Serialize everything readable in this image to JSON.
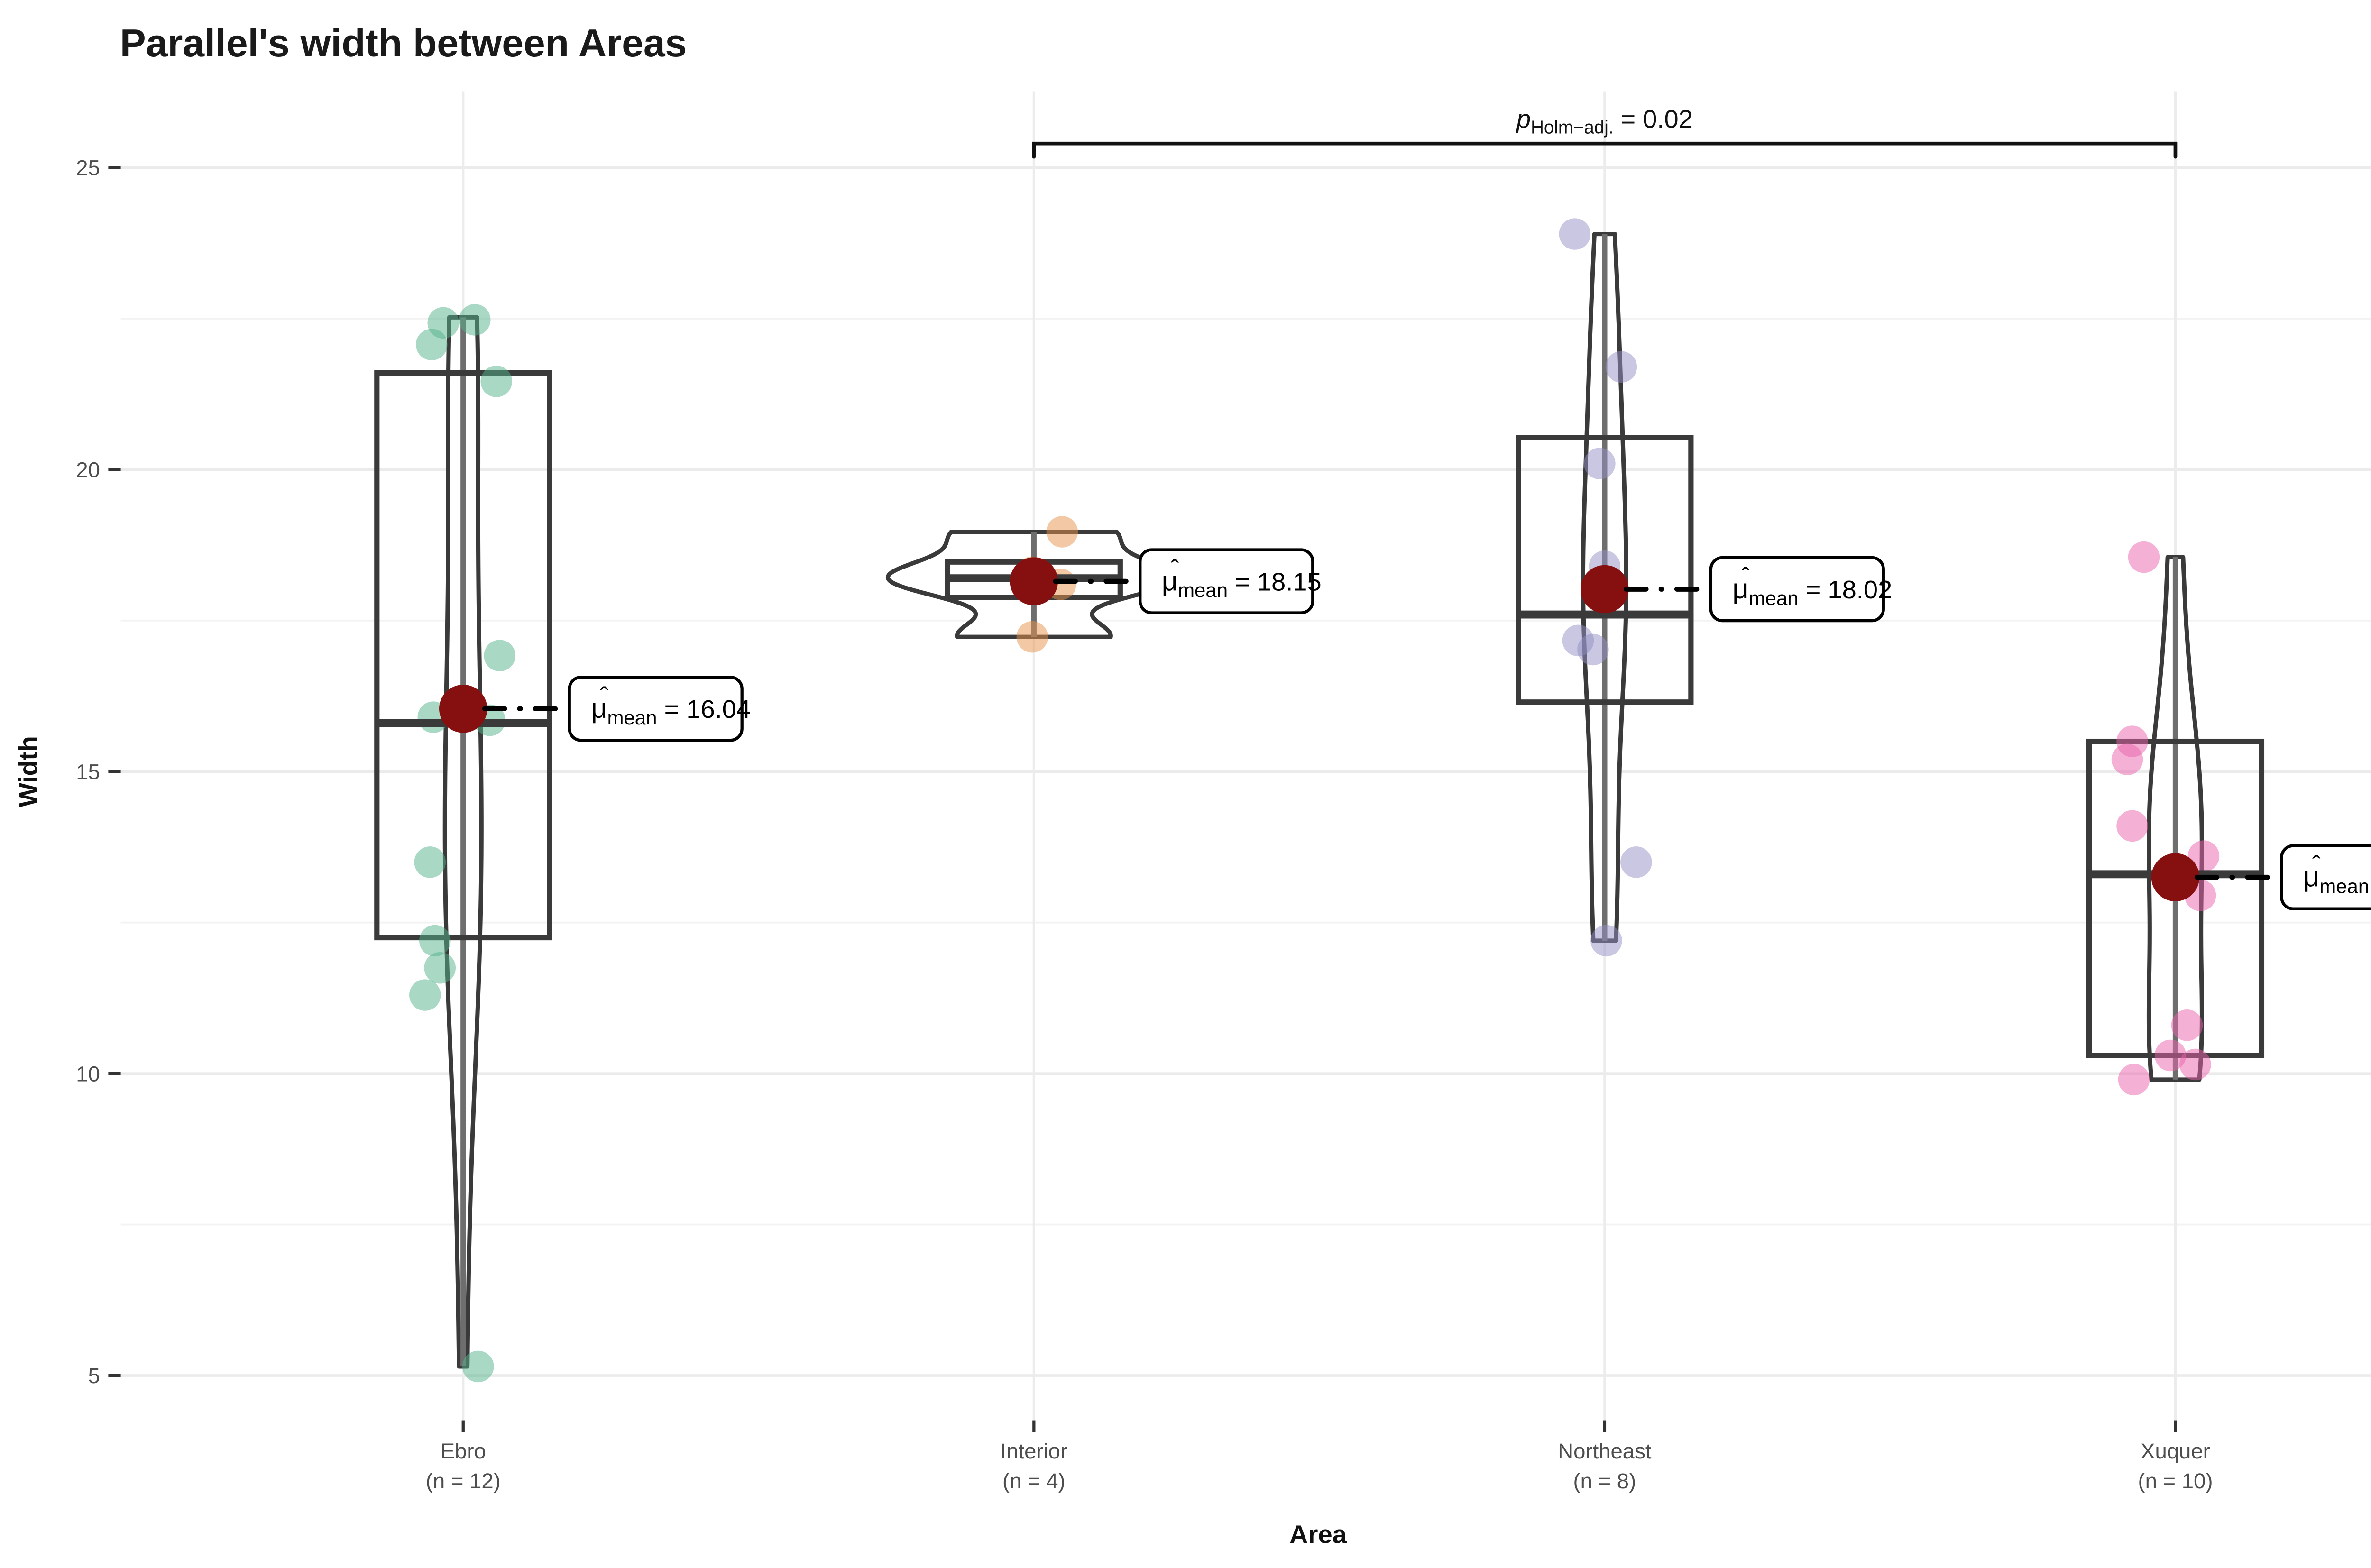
{
  "chart_data": {
    "type": "violin-box-jitter",
    "title": "Parallel's width between Areas",
    "xlabel": "Area",
    "ylabel": "Width",
    "ylim": [
      4.2,
      26.5
    ],
    "yticks": [
      5,
      10,
      15,
      20,
      25
    ],
    "yticks_minor": [
      7.5,
      12.5,
      17.5,
      22.5
    ],
    "grid": true,
    "legend_position": "none",
    "mean_label_parts": {
      "hat": "ˆ",
      "mu": "μ",
      "sub": "mean",
      "eq": " = "
    },
    "groups": [
      {
        "label": "Ebro",
        "n": 12,
        "n_label": "(n = 12)",
        "color": "#53b28c",
        "points": [
          {
            "v": 22.48,
            "dx": 7
          },
          {
            "v": 22.43,
            "dx": -12
          },
          {
            "v": 22.07,
            "dx": -19
          },
          {
            "v": 21.46,
            "dx": 20
          },
          {
            "v": 16.92,
            "dx": 22
          },
          {
            "v": 15.9,
            "dx": -18
          },
          {
            "v": 15.85,
            "dx": 16
          },
          {
            "v": 13.5,
            "dx": -20
          },
          {
            "v": 12.2,
            "dx": -17
          },
          {
            "v": 11.75,
            "dx": -14
          },
          {
            "v": 11.3,
            "dx": -23
          },
          {
            "v": 5.15,
            "dx": 9
          }
        ],
        "box": {
          "q1": 12.25,
          "median": 15.8,
          "q3": 21.6
        },
        "whisker": {
          "min": 5.15,
          "max": 22.52
        },
        "violin": {
          "min": 5.15,
          "max": 22.52,
          "halfwidth": 11
        },
        "mean": 16.04,
        "mean_label_value": "16.04"
      },
      {
        "label": "Interior",
        "n": 4,
        "n_label": "(n = 4)",
        "color": "#e8924a",
        "points": [
          {
            "v": 18.97,
            "dx": 17
          },
          {
            "v": 18.3,
            "dx": -1
          },
          {
            "v": 18.1,
            "dx": 16
          },
          {
            "v": 17.23,
            "dx": -1
          }
        ],
        "box": {
          "q1": 17.88,
          "median": 18.2,
          "q3": 18.47
        },
        "whisker": {
          "min": 17.23,
          "max": 18.97
        },
        "violin": {
          "min": 17.23,
          "max": 18.97,
          "halfwidth": 88
        },
        "mean": 18.15,
        "mean_label_value": "18.15"
      },
      {
        "label": "Northeast",
        "n": 8,
        "n_label": "(n = 8)",
        "color": "#938fc4",
        "points": [
          {
            "v": 23.9,
            "dx": -18
          },
          {
            "v": 21.7,
            "dx": 10
          },
          {
            "v": 20.1,
            "dx": -3
          },
          {
            "v": 18.4,
            "dx": 0
          },
          {
            "v": 17.17,
            "dx": -16
          },
          {
            "v": 17.02,
            "dx": -7
          },
          {
            "v": 13.5,
            "dx": 19
          },
          {
            "v": 12.2,
            "dx": 1
          }
        ],
        "box": {
          "q1": 16.15,
          "median": 17.6,
          "q3": 20.53
        },
        "whisker": {
          "min": 12.2,
          "max": 23.9
        },
        "violin": {
          "min": 12.2,
          "max": 23.9,
          "halfwidth": 13
        },
        "mean": 18.02,
        "mean_label_value": "18.02"
      },
      {
        "label": "Xuquer",
        "n": 10,
        "n_label": "(n = 10)",
        "color": "#ea64ab",
        "points": [
          {
            "v": 18.55,
            "dx": -19
          },
          {
            "v": 15.5,
            "dx": -26
          },
          {
            "v": 15.2,
            "dx": -29
          },
          {
            "v": 14.1,
            "dx": -26
          },
          {
            "v": 13.6,
            "dx": 17
          },
          {
            "v": 12.95,
            "dx": 15
          },
          {
            "v": 10.8,
            "dx": 7
          },
          {
            "v": 10.3,
            "dx": -3
          },
          {
            "v": 10.15,
            "dx": 12
          },
          {
            "v": 9.9,
            "dx": -25
          }
        ],
        "box": {
          "q1": 10.3,
          "median": 13.3,
          "q3": 15.5
        },
        "whisker": {
          "min": 9.9,
          "max": 18.55
        },
        "violin": {
          "min": 9.9,
          "max": 18.55,
          "halfwidth": 16
        },
        "mean": 13.25,
        "mean_label_value": "13.25"
      }
    ],
    "significance": {
      "from_group": "Interior",
      "to_group": "Xuquer",
      "p_italic": "p",
      "p_sub": "Holm−adj.",
      "p_eq": " = 0.02"
    },
    "caption_segments": [
      {
        "text": "Pairwise test: ",
        "bold": false
      },
      {
        "text": "Games-Howell",
        "bold": true
      },
      {
        "text": ", Bars shown: ",
        "bold": false
      },
      {
        "text": "significant",
        "bold": true
      }
    ]
  },
  "colors": {
    "mean_dot": "#861010",
    "box_stroke": "#3a3a3a",
    "whisker": "#6e6e6e",
    "grid_major": "#ebebeb",
    "grid_minor": "#f3f3f3",
    "grid_vertical": "#ececec",
    "axis_tick": "#333333",
    "axis_text": "#4d4d4d",
    "bracket": "#111111",
    "background": "#ffffff"
  }
}
